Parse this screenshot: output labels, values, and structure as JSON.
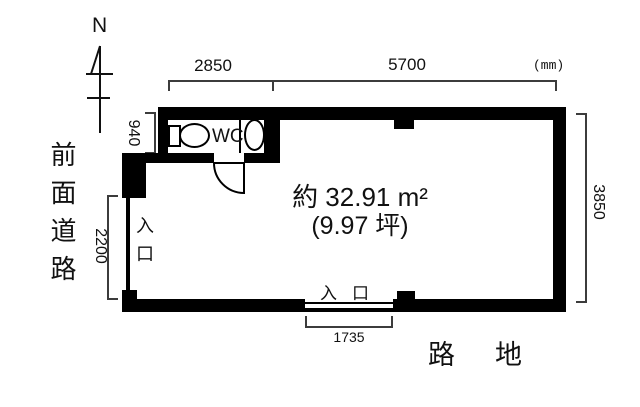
{
  "compass": {
    "label": "N"
  },
  "labels": {
    "front_road": "前面道路",
    "alley": "路地",
    "unit": "(mm)",
    "wc": "WC",
    "entrance_left": "入口",
    "entrance_bottom": "入口",
    "area_m2": "約 32.91 m²",
    "area_tsubo": "(9.97 坪)"
  },
  "dimensions_mm": {
    "top_left": "2850",
    "top_right": "5700",
    "wc_depth": "940",
    "left_entrance": "2200",
    "right_side": "3850",
    "bottom_entrance": "1735"
  },
  "colors": {
    "wall": "#000000",
    "dim_line": "#3c3c3c",
    "background": "#ffffff"
  }
}
